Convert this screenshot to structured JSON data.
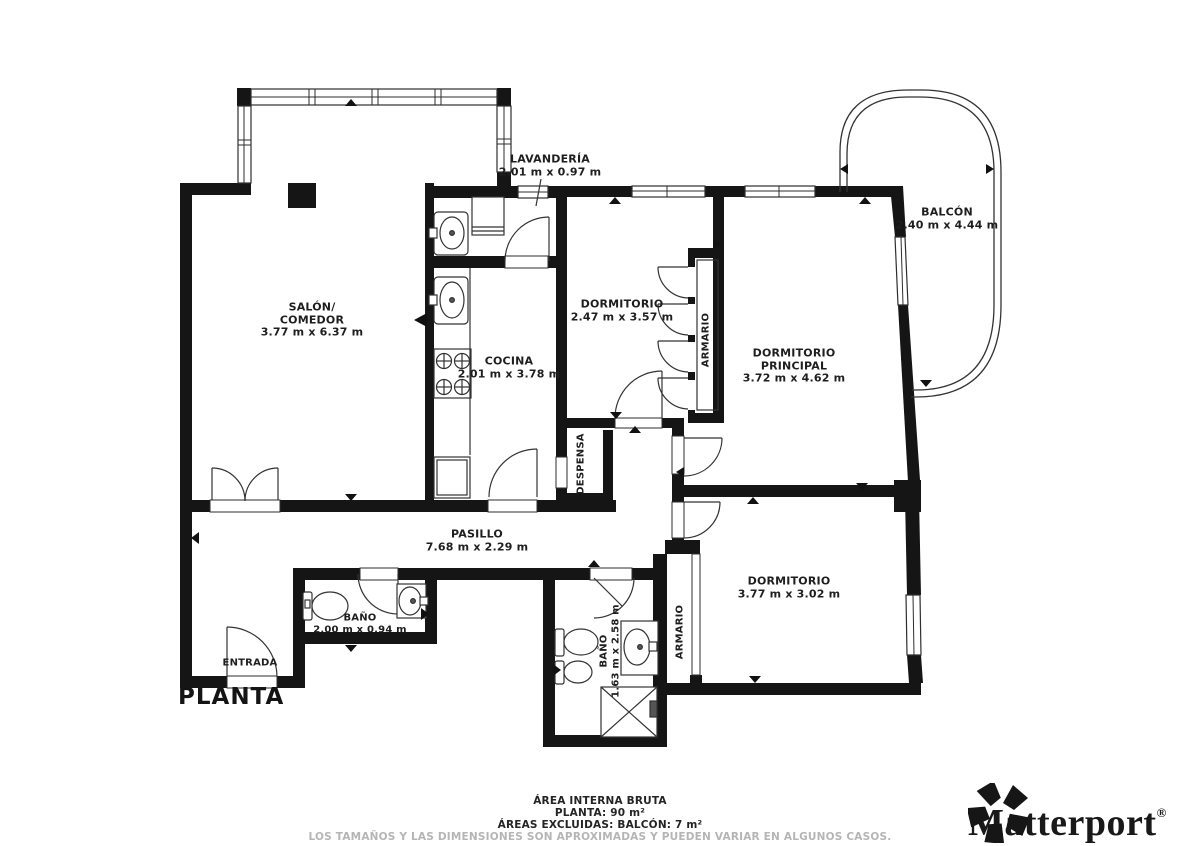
{
  "title": "PLANTA",
  "rooms": {
    "salon": {
      "name": "SALÓN/",
      "name2": "COMEDOR",
      "dims": "3.77 m x 6.37 m"
    },
    "lavanderia": {
      "name": "LAVANDERÍA",
      "dims": "2.01 m x 0.97 m"
    },
    "cocina": {
      "name": "COCINA",
      "dims": "2.01 m x 3.78 m"
    },
    "dormitorio1": {
      "name": "DORMITORIO",
      "dims": "2.47 m x 3.57 m"
    },
    "armario1": {
      "name": "ARMARIO"
    },
    "principal": {
      "name": "DORMITORIO",
      "name2": "PRINCIPAL",
      "dims": "3.72 m x 4.62 m"
    },
    "balcon": {
      "name": "BALCÓN",
      "dims": "2.40 m x 4.44 m"
    },
    "despensa": {
      "name": "DESPENSA"
    },
    "pasillo": {
      "name": "PASILLO",
      "dims": "7.68 m x 2.29 m"
    },
    "bano1": {
      "name": "BAÑO",
      "dims": "2.00 m x 0.94 m"
    },
    "entrada": {
      "name": "ENTRADA"
    },
    "bano2": {
      "name": "BAÑO",
      "dims": "1.63 m x 2.58 m"
    },
    "armario2": {
      "name": "ARMARIO"
    },
    "dormitorio2": {
      "name": "DORMITORIO",
      "dims": "3.77 m x 3.02 m"
    }
  },
  "footer": {
    "area_title": "ÁREA INTERNA BRUTA",
    "planta": "PLANTA: 90 m²",
    "excluded": "ÁREAS EXCLUIDAS: BALCÓN: 7 m²",
    "disclaimer": "LOS TAMAÑOS Y LAS DIMENSIONES SON APROXIMADAS Y PUEDEN VARIAR EN ALGUNOS CASOS."
  },
  "brand": {
    "name": "Matterport",
    "registered": "®",
    "icon": "matterport-pinwheel-icon",
    "color": "#191919"
  },
  "colors": {
    "wall": "#151515",
    "line": "#2e2e2e",
    "text": "#1e1e1e",
    "muted": "#b5b5b5"
  }
}
